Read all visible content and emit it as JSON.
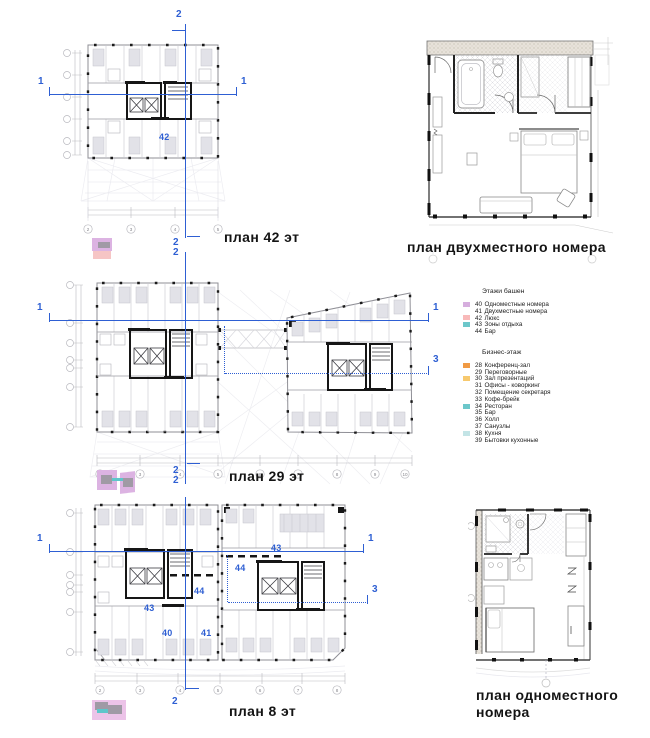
{
  "sheet": {
    "background": "#ffffff",
    "accent_blue": "#2e5fd3"
  },
  "plans": {
    "floor42": {
      "title": "план 42 эт",
      "room_label": "42",
      "grid_cols": [
        "2",
        "3",
        "4",
        "5"
      ]
    },
    "floor29": {
      "title": "план 29 эт",
      "grid_cols": [
        "2",
        "3",
        "4",
        "5",
        "6",
        "7",
        "8",
        "9",
        "10"
      ]
    },
    "floor8": {
      "title": "план 8 эт",
      "room_labels": [
        "43",
        "44",
        "44",
        "43",
        "40",
        "41"
      ],
      "grid_cols": [
        "2",
        "3",
        "4",
        "5",
        "6",
        "7",
        "8"
      ]
    },
    "double_room": {
      "title": "план двухместного номера"
    },
    "single_room": {
      "title_line1": "план одноместного",
      "title_line2": "номера"
    }
  },
  "section_marks": {
    "s1": "1",
    "s2": "2",
    "s3": "3"
  },
  "legend": {
    "groups": [
      {
        "title": "Этажи башен",
        "items": [
          {
            "num": "40",
            "label": "Одноместные номера",
            "swatch": "#d6aede"
          },
          {
            "num": "41",
            "label": "Двухместные номера",
            "swatch": null
          },
          {
            "num": "42",
            "label": "Люкс",
            "swatch": "#f8b9b9"
          },
          {
            "num": "43",
            "label": "Зоны отдыха",
            "swatch": "#6cc7ca"
          },
          {
            "num": "44",
            "label": "Бар",
            "swatch": null
          }
        ]
      },
      {
        "title": "Бизнес-этаж",
        "items": [
          {
            "num": "28",
            "label": "Конференц-зал",
            "swatch": "#f09a44"
          },
          {
            "num": "29",
            "label": "Переговорные",
            "swatch": null
          },
          {
            "num": "30",
            "label": "Зал презентаций",
            "swatch": "#f7c96e"
          },
          {
            "num": "31",
            "label": "Офисы - коворкинг",
            "swatch": null
          },
          {
            "num": "32",
            "label": "Помещение секретаря",
            "swatch": null
          },
          {
            "num": "33",
            "label": "Кофе-брейк",
            "swatch": null
          },
          {
            "num": "34",
            "label": "Ресторан",
            "swatch": "#6cc7ca"
          },
          {
            "num": "35",
            "label": "Бар",
            "swatch": null
          },
          {
            "num": "36",
            "label": "Холл",
            "swatch": null
          },
          {
            "num": "37",
            "label": "Санузлы",
            "swatch": null
          },
          {
            "num": "38",
            "label": "Кухня",
            "swatch": "#c3e4e6"
          },
          {
            "num": "39",
            "label": "Бытовки кухонные",
            "swatch": null
          }
        ]
      }
    ]
  }
}
